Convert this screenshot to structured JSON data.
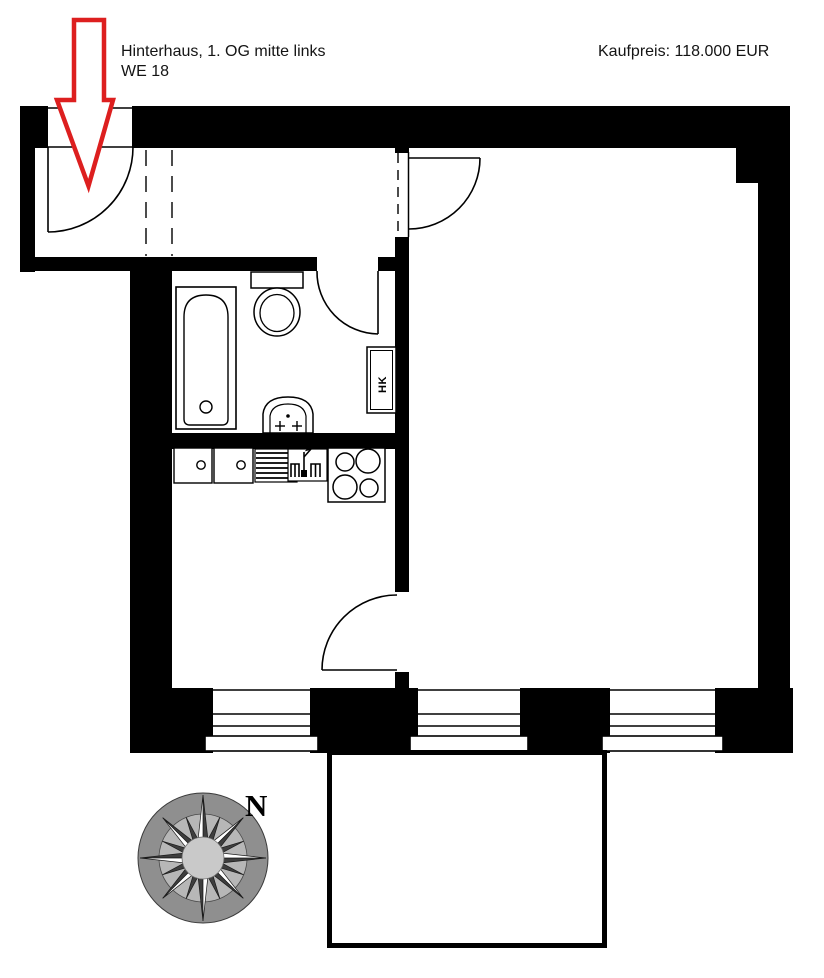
{
  "annotations": {
    "title_line1": "Hinterhaus, 1. OG mitte links",
    "title_line2": "WE 18",
    "price": "Kaufpreis: 118.000 EUR"
  },
  "plan": {
    "radiator_label": "HK",
    "compass_label": "N"
  },
  "colors": {
    "wall_black": "#000000",
    "arrow_red": "#dd1f1f",
    "compass_outer": "#8f8f8f",
    "compass_ring": "#b7b7b7",
    "compass_center": "#c9c9c9",
    "compass_point_dark": "#3e3e3e"
  }
}
